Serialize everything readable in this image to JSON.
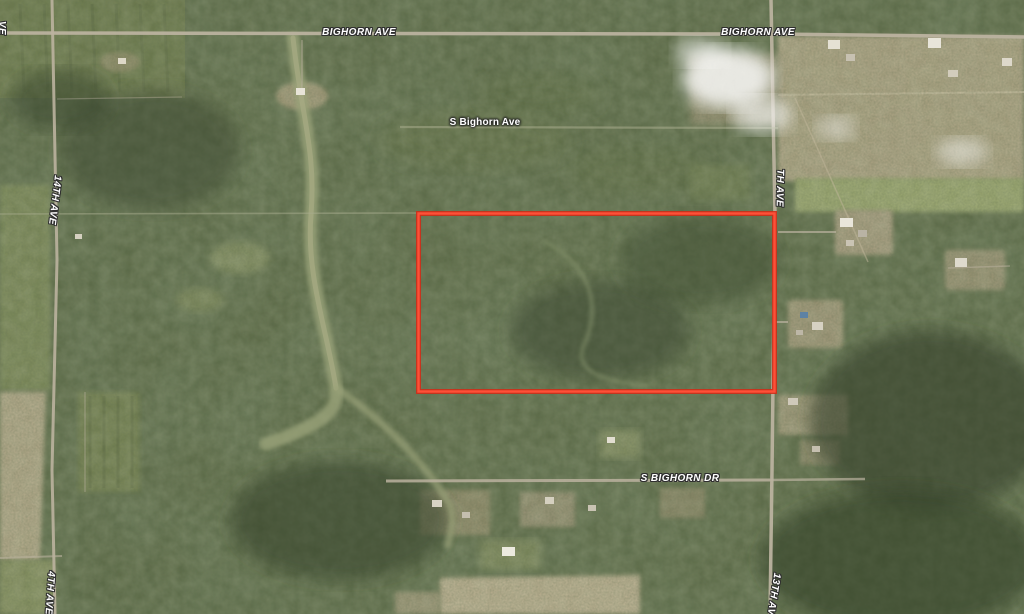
{
  "map": {
    "view": "satellite",
    "road_labels": {
      "bighorn_ave_west": "BIGHORN AVE",
      "bighorn_ave_east": "BIGHORN AVE",
      "s_bighorn_ave": "S Bighorn Ave",
      "fourteenth_ave": "14TH AVE",
      "th_ave": "TH AVE",
      "s_bighorn_dr": "S BIGHORN DR",
      "thirteenth_ave": "13TH AV",
      "fourteenth_ave_south": "4TH AVE",
      "left_edge_fragment": "VE"
    },
    "parcel": {
      "outline_color": "#f23c24"
    },
    "palette": {
      "forest": "#55633f",
      "forest_dark": "#36422b",
      "field_green": "#8d9a67",
      "field_tan": "#b5aa8b",
      "road": "#bbb29f",
      "label_text": "#ffffff",
      "label_halo": "#2f2f2f",
      "smoke": "#ffffff"
    }
  }
}
